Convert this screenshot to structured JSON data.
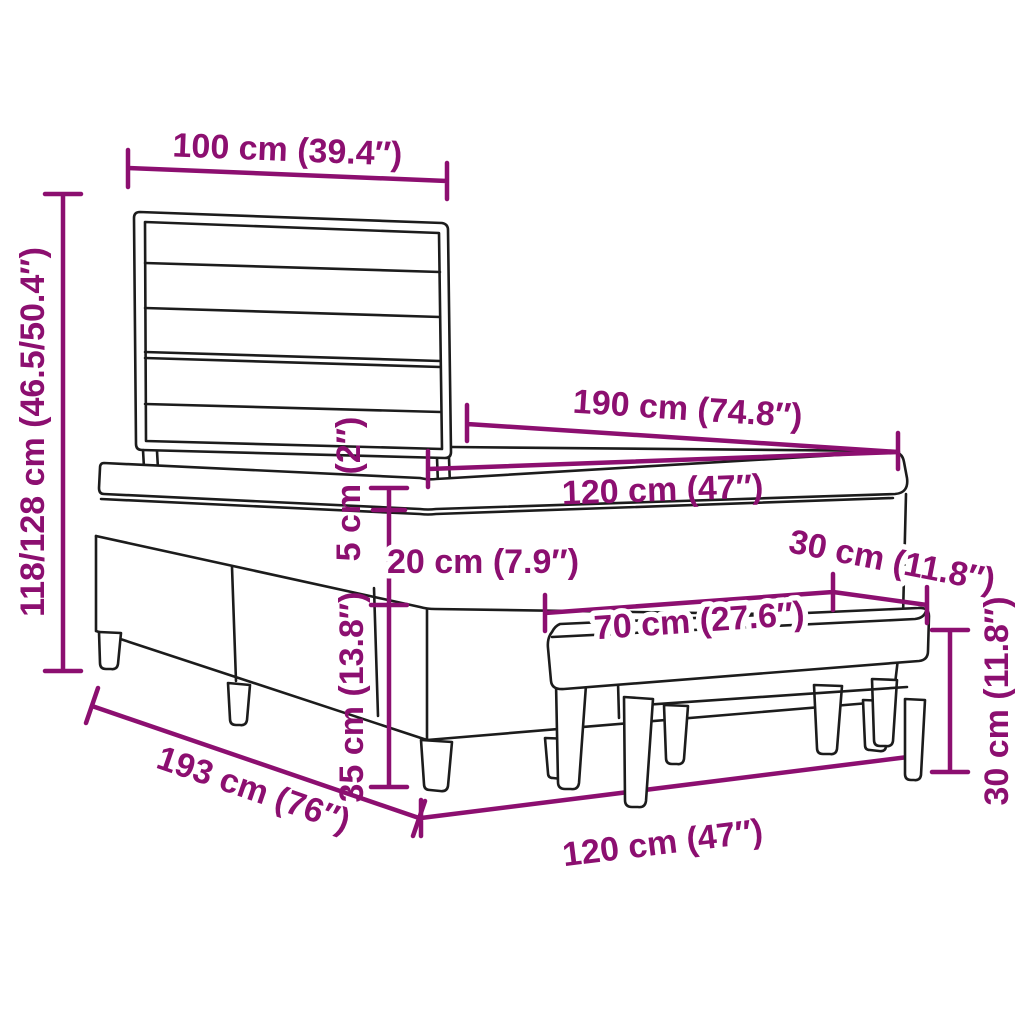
{
  "diagram": {
    "title": "bed-with-bench-dimension-diagram",
    "accent_color": "#8C0F70",
    "outline_color": "#1c1c1c",
    "background_color": "#ffffff",
    "labels": {
      "headboard_width": "100 cm (39.4″)",
      "total_height": "118/128 cm (46.5/50.4″)",
      "bed_length": "190 cm (74.8″)",
      "bed_width_top": "120 cm (47″)",
      "topper_height": "5 cm (2″)",
      "mattress_height": "20 cm (7.9″)",
      "base_height": "35 cm (13.8″)",
      "frame_length": "193 cm (76″)",
      "bed_width_bottom": "120 cm (47″)",
      "bench_length": "70 cm (27.6″)",
      "bench_depth": "30 cm (11.8″)",
      "bench_height": "30 cm (11.8″)"
    }
  }
}
